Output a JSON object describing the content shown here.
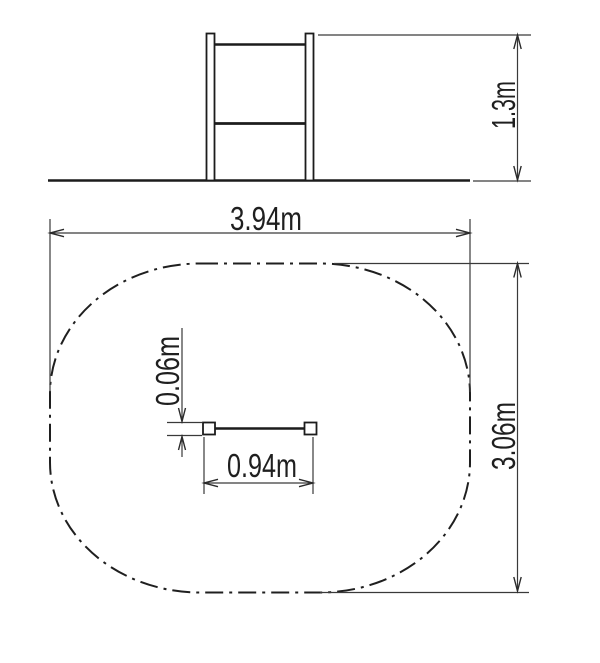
{
  "drawing": {
    "type": "technical-dimension-drawing",
    "subject": "horizontal bar with safety zone",
    "background_color": "#ffffff",
    "line_color": "#1c1c1c",
    "views": {
      "elevation": {
        "description": "front elevation of two posts with top bar and middle bar on ground line",
        "dimensions": {
          "height": {
            "label": "1.3m"
          }
        }
      },
      "plan": {
        "description": "plan view of safety zone (chain-line rounded rectangle) with bar between two posts",
        "dimensions": {
          "zone_width": {
            "label": "3.94m"
          },
          "zone_depth": {
            "label": "3.06m"
          },
          "bar_length": {
            "label": "0.94m"
          },
          "bar_width": {
            "label": "0.06m"
          }
        }
      }
    }
  }
}
